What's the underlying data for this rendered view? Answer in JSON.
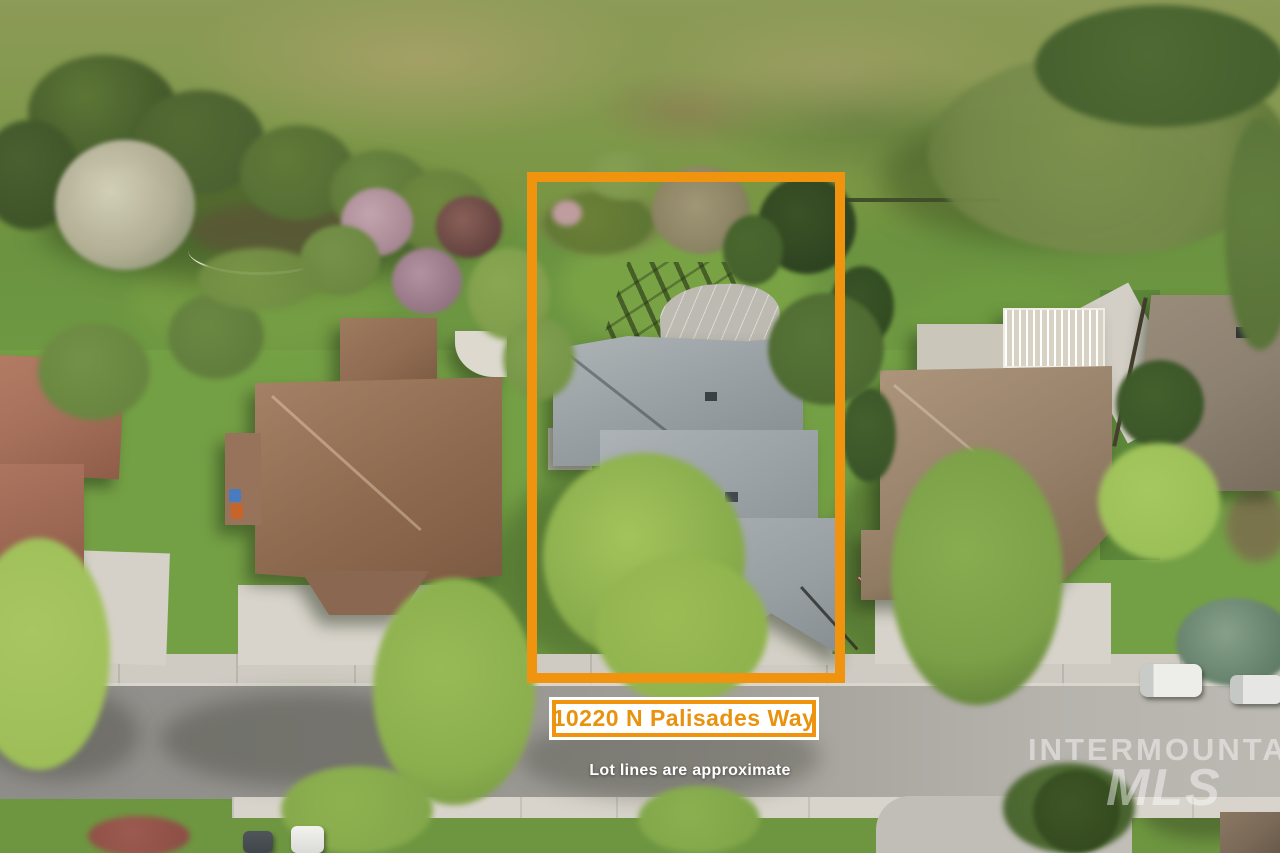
{
  "overlay": {
    "address_label": "10220 N Palisades Way",
    "disclaimer": "Lot lines are approximate"
  },
  "watermark": {
    "line1": "INTERMOUNTAIN",
    "line2": "MLS"
  },
  "colors": {
    "boundary-orange": "#F0930F",
    "label-text": "#E8920E",
    "label-bg": "#FFFFFF",
    "disclaimer-text": "#FFFFFF",
    "watermark-white": "rgba(255,255,255,0.45)"
  }
}
